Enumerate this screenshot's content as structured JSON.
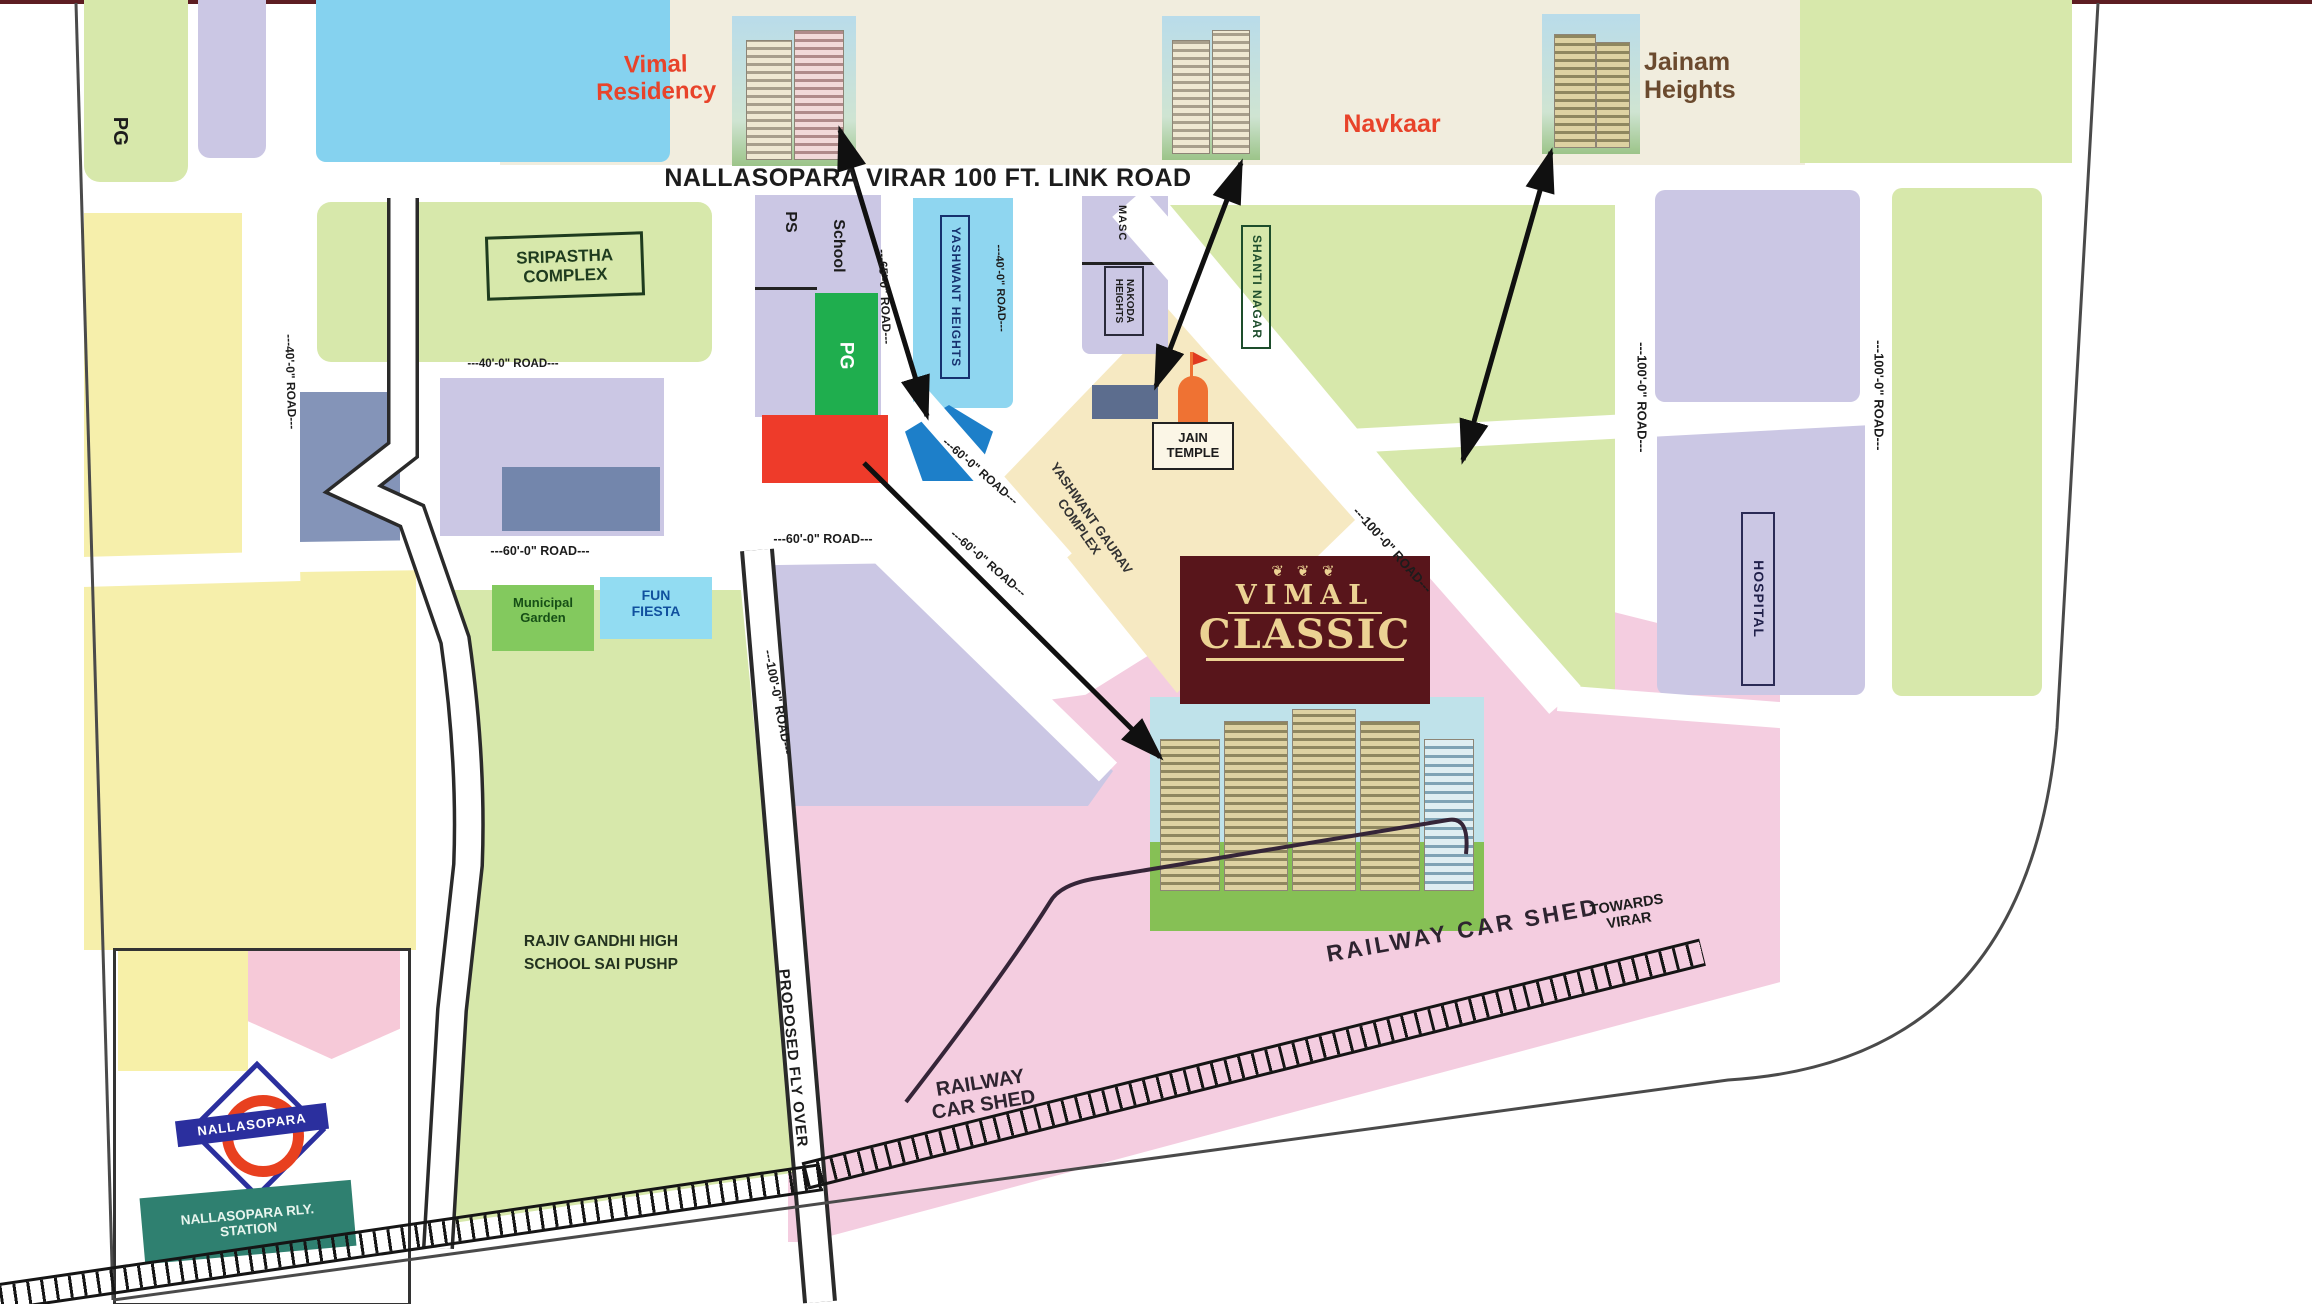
{
  "title": "Vimal Classic location map",
  "top_band": {
    "vimal_residency": "Vimal Residency",
    "navkaar": "Navkaar",
    "jainam_heights": "Jainam Heights"
  },
  "link_road": "NALLASOPARA VIRAR 100 FT. LINK ROAD",
  "logo": {
    "name_top": "VIMAL",
    "name_bottom": "CLASSIC",
    "ornament": "❦ ❦ ❦"
  },
  "places": {
    "pg_left": "PG",
    "ps": "PS",
    "school": "School",
    "pg_green": "PG",
    "sripastha": "SRIPASTHA COMPLEX",
    "yashwant_heights": "YASHWANT HEIGHTS",
    "masjid": "MASC",
    "nakoda": "NAKODA HEIGHTS",
    "shanti_nagar": "SHANTI NAGAR",
    "jain_temple": "JAIN TEMPLE",
    "yashwant_gaurav": "YASHWANT GAURAV COMPLEX",
    "hospital": "HOSPITAL",
    "municipal_garden": "Municipal Garden",
    "fun_fiesta": "FUN FIESTA",
    "rajiv_gandhi": "RAJIV GANDHI HIGH SCHOOL SAI PUSHP",
    "railway_car_shed": "RAILWAY CAR SHED",
    "railway_car_shed_2": "RAILWAY CAR SHED",
    "proposed_flyover": "PROPOSED FLY OVER",
    "towards_virar": "TOWARDS VIRAR"
  },
  "station": {
    "logo_text": "NALLASOPARA",
    "sign": "NALLASOPARA RLY. STATION"
  },
  "roads": {
    "r40": "---40'-0\" ROAD---",
    "r60": "---60'-0\" ROAD---",
    "r65": "---65'-0\" ROAD---",
    "r100": "---100'-0\" ROAD---"
  },
  "colors": {
    "project_red": "#e8432a",
    "jainam_brown": "#6b4a2e",
    "logo_maroon": "#58151b",
    "logo_gold": "#ecd293",
    "block_green": "#d7e8ab",
    "block_lavender": "#cbc7e4",
    "block_cyan": "#8fd6f0",
    "plot_red": "#ee3b2a",
    "plot_green": "#1fae4e",
    "plot_blue": "#1d7fc9",
    "block_slate": "#8494b8",
    "block_yellow": "#f6efab",
    "block_pink": "#f4cde0",
    "block_cream": "#f6e9c2",
    "station_sign_green": "#2f8070",
    "station_logo_blue": "#2b2f9e",
    "station_logo_red": "#e8401f"
  }
}
